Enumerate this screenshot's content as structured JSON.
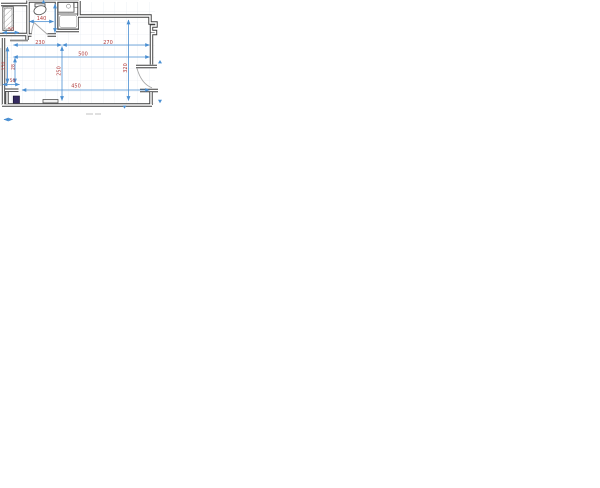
{
  "plan": {
    "dimensions": {
      "top_segment_left": "230",
      "top_segment_right": "270",
      "top_total": "500",
      "bottom_span": "450",
      "entry_niche_width": "50",
      "left_lower_offset": "50",
      "left_wall_height": "150",
      "left_wall_inner": "28",
      "room_depth_mid": "250",
      "room_depth_right": "320",
      "bathroom_width": "140"
    },
    "colors": {
      "wall": "#3f3f3f",
      "dimension_line": "#4a8fd2",
      "dimension_text": "#b03a3a",
      "shaft_fill": "#342a60",
      "grid_line": "#e3e8ef",
      "door_arc": "#a8a8a8"
    }
  }
}
